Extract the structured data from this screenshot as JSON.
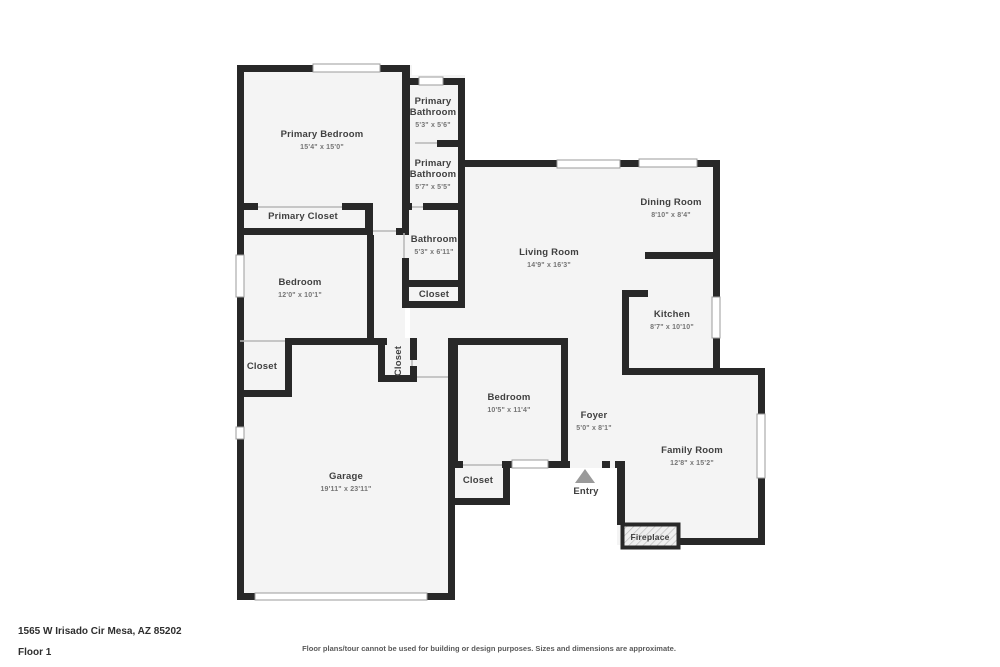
{
  "meta": {
    "address": "1565 W Irisado Cir Mesa, AZ 85202",
    "floor_label": "Floor 1",
    "disclaimer": "Floor plans/tour cannot be used for building or design purposes. Sizes and dimensions are approximate."
  },
  "colors": {
    "background": "#ffffff",
    "wall": "#282828",
    "room_fill": "#f4f4f4",
    "window_stroke": "#9b9b9b",
    "door_line": "#b6b6b6",
    "name_text": "#404040",
    "dims_text": "#757575",
    "entry_arrow": "#9a9a9a",
    "hatch": "#bdbdbd"
  },
  "plan": {
    "rooms": [
      {
        "id": "primary-bedroom",
        "label": "Primary Bedroom",
        "dims": "15'4\" x 15'0\""
      },
      {
        "id": "primary-bathroom-1",
        "label": "Primary Bathroom",
        "dims": "5'3\" x 5'6\""
      },
      {
        "id": "primary-bathroom-2",
        "label": "Primary Bathroom",
        "dims": "5'7\" x 5'5\""
      },
      {
        "id": "primary-closet",
        "label": "Primary Closet",
        "dims": ""
      },
      {
        "id": "bathroom",
        "label": "Bathroom",
        "dims": "5'3\" x 6'11\""
      },
      {
        "id": "hall-closet",
        "label": "Closet",
        "dims": ""
      },
      {
        "id": "bedroom-2",
        "label": "Bedroom",
        "dims": "12'0\" x 10'1\""
      },
      {
        "id": "living-room",
        "label": "Living Room",
        "dims": "14'9\" x 16'3\""
      },
      {
        "id": "dining-room",
        "label": "Dining Room",
        "dims": "8'10\" x 8'4\""
      },
      {
        "id": "kitchen",
        "label": "Kitchen",
        "dims": "8'7\" x 10'10\""
      },
      {
        "id": "closet-vertical",
        "label": "Closet",
        "dims": ""
      },
      {
        "id": "bedroom-closet",
        "label": "Closet",
        "dims": ""
      },
      {
        "id": "bedroom-3",
        "label": "Bedroom",
        "dims": "10'5\" x 11'4\""
      },
      {
        "id": "foyer",
        "label": "Foyer",
        "dims": "5'0\" x 8'1\""
      },
      {
        "id": "family-room",
        "label": "Family Room",
        "dims": "12'8\" x 15'2\""
      },
      {
        "id": "garage",
        "label": "Garage",
        "dims": "19'11\" x 23'11\""
      },
      {
        "id": "entry-closet",
        "label": "Closet",
        "dims": ""
      },
      {
        "id": "entry",
        "label": "Entry",
        "dims": ""
      },
      {
        "id": "fireplace",
        "label": "Fireplace",
        "dims": ""
      }
    ]
  }
}
